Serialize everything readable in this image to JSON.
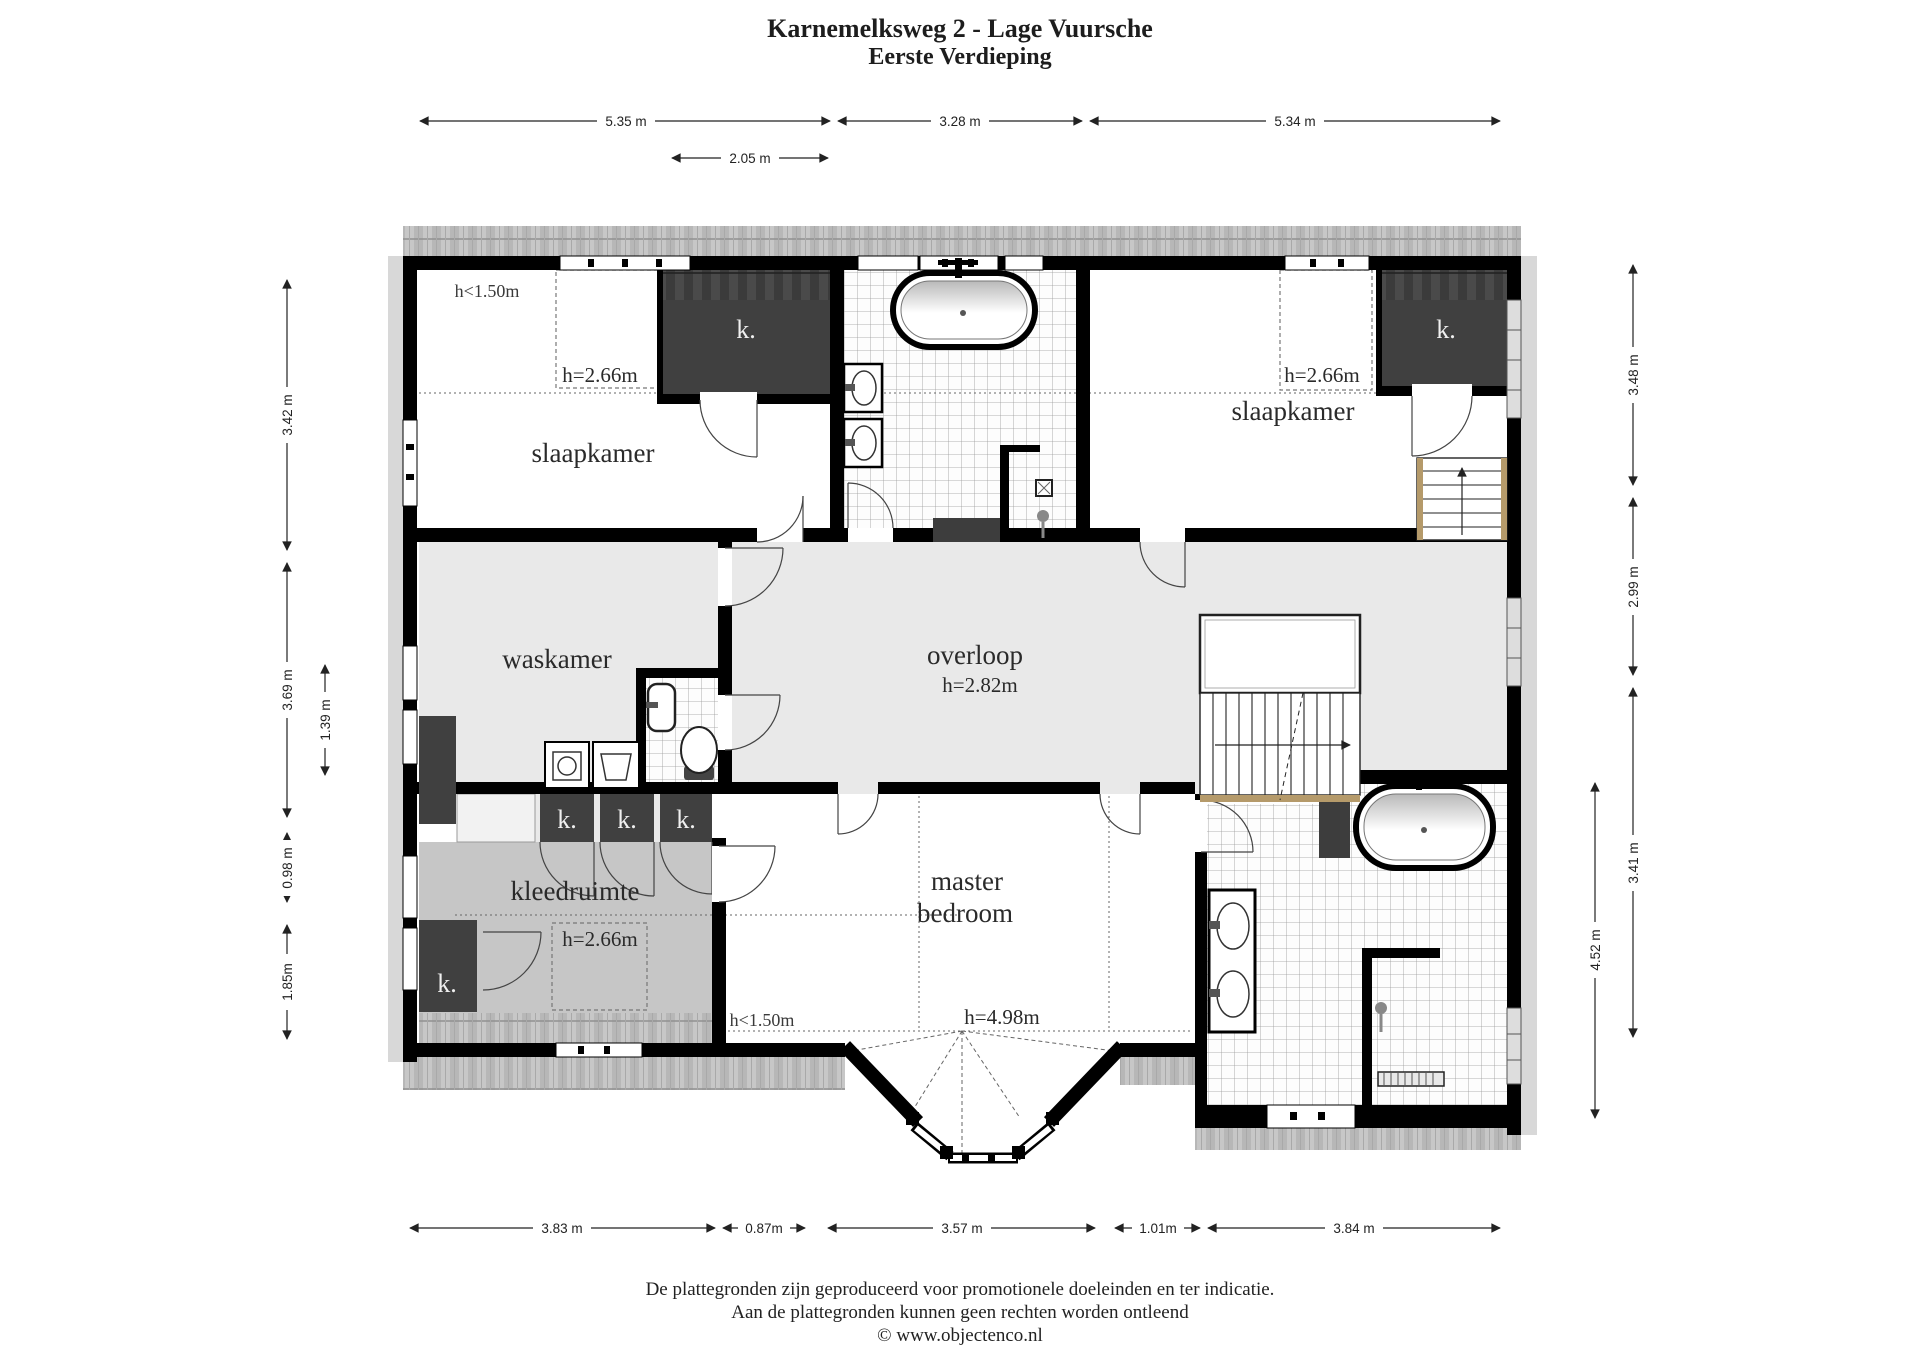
{
  "title": {
    "line1": "Karnemelksweg 2 - Lage Vuursche",
    "line2": "Eerste Verdieping"
  },
  "rooms": {
    "slaapkamer_left": {
      "name": "slaapkamer",
      "dormer_height": "h=2.66m",
      "low_ceiling": "h<1.50m"
    },
    "slaapkamer_right": {
      "name": "slaapkamer",
      "dormer_height": "h=2.66m"
    },
    "waskamer": {
      "name": "waskamer"
    },
    "overloop": {
      "name": "overloop",
      "height": "h=2.82m"
    },
    "kleedruimte": {
      "name": "kleedruimte",
      "dormer_height": "h=2.66m",
      "low_ceiling": "h<1.50m"
    },
    "master_bedroom": {
      "name_line1": "master",
      "name_line2": "bedroom",
      "height": "h=4.98m"
    },
    "closet_label": "k."
  },
  "dimensions": {
    "top": [
      "5.35 m",
      "3.28 m",
      "5.34 m"
    ],
    "top_inner": "2.05 m",
    "left": [
      "3.42 m",
      "3.69 m",
      "1.39 m",
      "0.98 m",
      "1.85m"
    ],
    "right": [
      "3.48 m",
      "2.99 m",
      "3.41 m",
      "4.52 m"
    ],
    "bottom": [
      "3.83 m",
      "0.87m",
      "3.57 m",
      "1.01m",
      "3.84 m"
    ]
  },
  "footer": {
    "line1": "De plattegronden zijn geproduceerd voor promotionele doeleinden en ter indicatie.",
    "line2": "Aan de plattegronden kunnen geen rechten worden ontleend",
    "line3": "© www.objectenco.nl"
  },
  "colors": {
    "wall": "#000000",
    "closet_fill": "#404040",
    "floor_light": "#e9e9e9",
    "floor_medium": "#c6c6c6",
    "roof_hatch": "#c0c0c0",
    "stair_nosing": "#b59a6a"
  }
}
